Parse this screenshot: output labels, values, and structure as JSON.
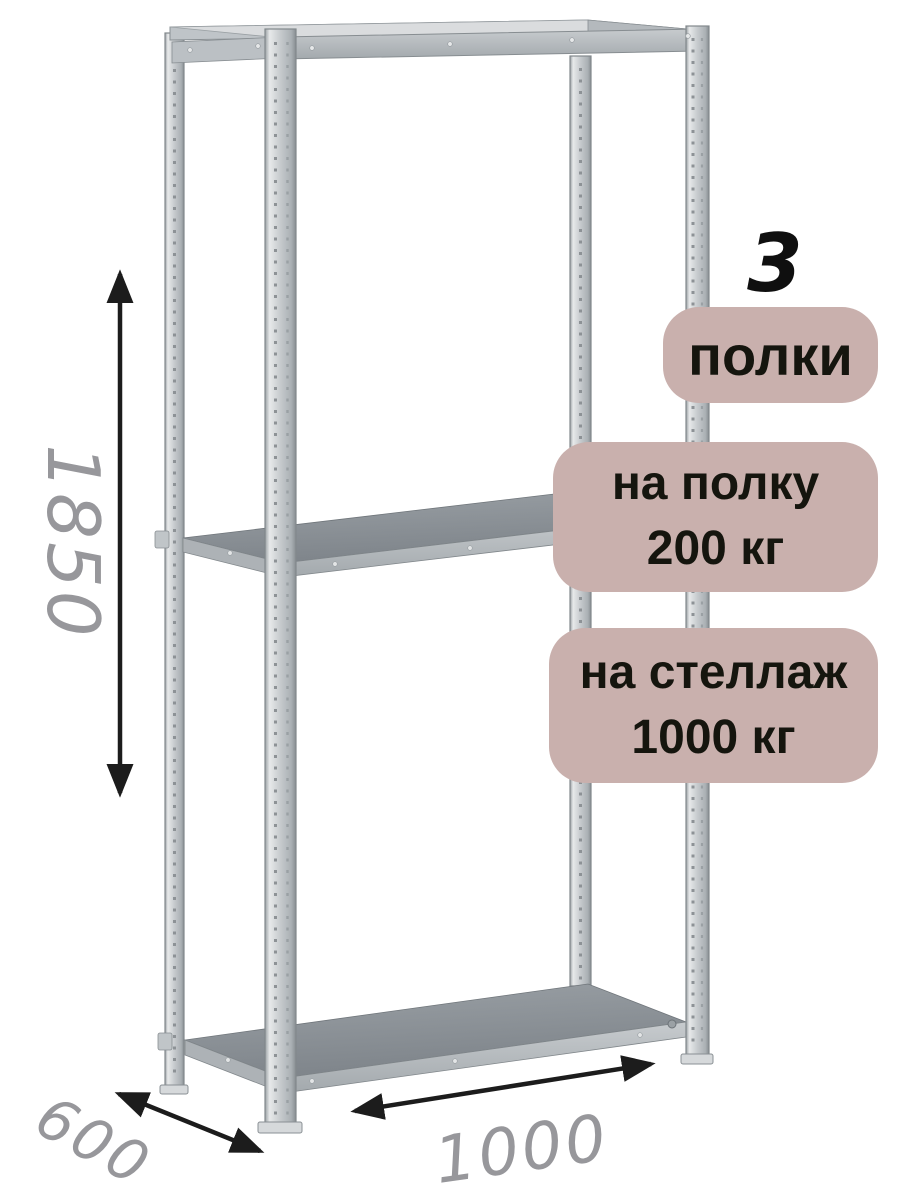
{
  "image_type": "annotated-product-illustration-of-metal-shelving-rack",
  "badges": {
    "shelf_count": {
      "value": "3",
      "label": "полки"
    },
    "per_shelf_load": {
      "line1": "на полку",
      "line2": "200 кг"
    },
    "total_load": {
      "line1": "на стеллаж",
      "line2": "1000 кг"
    }
  },
  "dimensions": {
    "height": "1850",
    "depth": "600",
    "width": "1000"
  },
  "colors": {
    "background": "#ffffff",
    "badge_background": "#c9b0ad",
    "badge_text": "#15150e",
    "dimension_text": "#97979b",
    "arrow": "#1c1c1c",
    "metal_light": "#cfd3d6",
    "metal_mid": "#b3b8bc",
    "shelf_surface": "#878d92"
  }
}
